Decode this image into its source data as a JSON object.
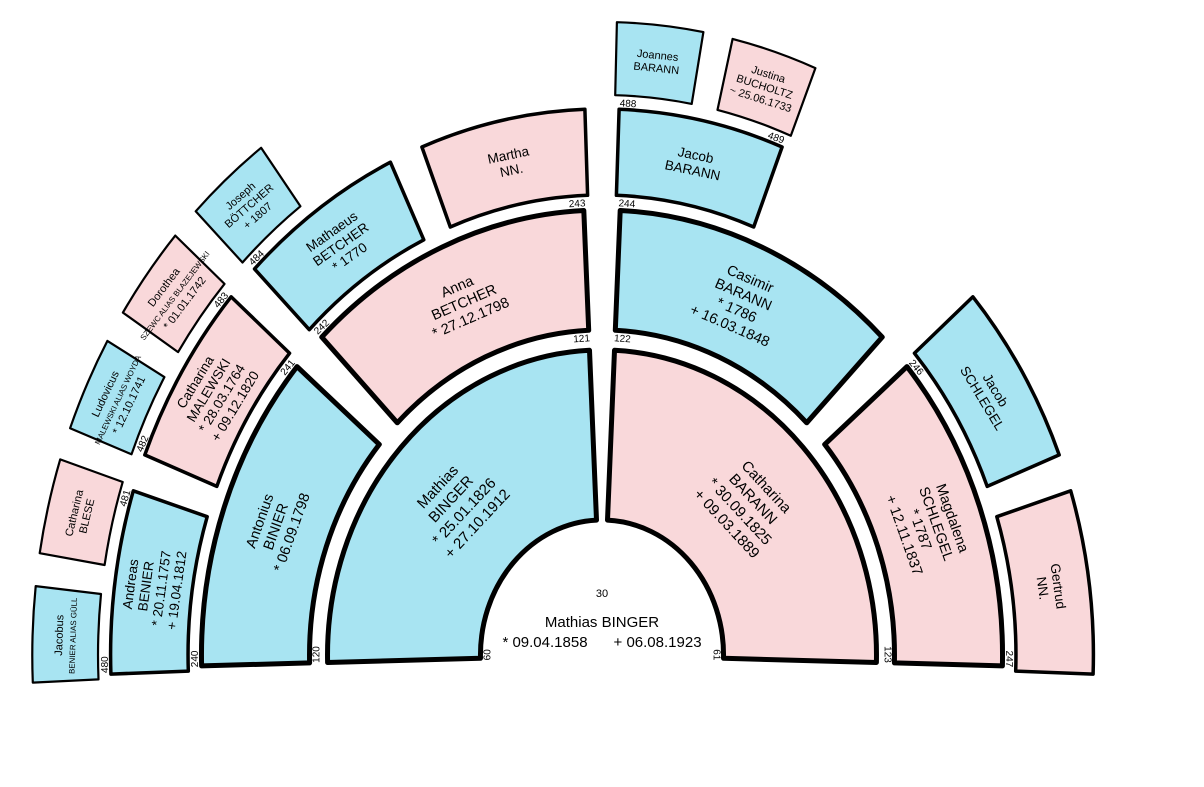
{
  "chart_data": {
    "type": "genealogy-fan",
    "center": {
      "number": "30",
      "name": "Mathias BINGER",
      "birth": "* 09.04.1858",
      "death": "+ 06.08.1923"
    },
    "colors": {
      "male": "#a8e4f2",
      "female": "#f9d8da",
      "outline": "#000000",
      "background": "#ffffff"
    },
    "persons": [
      {
        "number": "60",
        "sex": "male",
        "ring": 1,
        "slot": 0,
        "label_side": "start",
        "lines": [
          "Mathias",
          "BINGER",
          "* 25.01.1826",
          "+ 27.10.1912"
        ]
      },
      {
        "number": "61",
        "sex": "female",
        "ring": 1,
        "slot": 1,
        "label_side": "end",
        "lines": [
          "Catharina",
          "BARANN",
          "* 30.09.1825",
          "+ 09.03.1889"
        ]
      },
      {
        "number": "120",
        "sex": "male",
        "ring": 2,
        "slot": 0,
        "label_side": "start",
        "lines": [
          "Antonius",
          "BINIER",
          "* 06.09.1798"
        ]
      },
      {
        "number": "121",
        "sex": "female",
        "ring": 2,
        "slot": 1,
        "label_side": "end",
        "lines": [
          "Anna",
          "BETCHER",
          "* 27.12.1798"
        ]
      },
      {
        "number": "122",
        "sex": "male",
        "ring": 2,
        "slot": 2,
        "label_side": "start",
        "lines": [
          "Casimir",
          "BARANN",
          "* 1786",
          "+ 16.03.1848"
        ]
      },
      {
        "number": "123",
        "sex": "female",
        "ring": 2,
        "slot": 3,
        "label_side": "end",
        "lines": [
          "Magdalena",
          "SCHLEGEL",
          "* 1787",
          "+ 12.11.1837"
        ]
      },
      {
        "number": "240",
        "sex": "male",
        "ring": 3,
        "slot": 0,
        "label_side": "start",
        "lines": [
          "Andreas",
          "BENIER",
          "* 20.11.1757",
          "+ 19.04.1812"
        ]
      },
      {
        "number": "241",
        "sex": "female",
        "ring": 3,
        "slot": 1,
        "label_side": "end",
        "lines": [
          "Catharina",
          "MALEWSKI",
          "* 28.03.1764",
          "+ 09.12.1820"
        ]
      },
      {
        "number": "242",
        "sex": "male",
        "ring": 3,
        "slot": 2,
        "label_side": "start",
        "lines": [
          "Mathaeus",
          "BETCHER",
          "* 1770"
        ]
      },
      {
        "number": "243",
        "sex": "female",
        "ring": 3,
        "slot": 3,
        "label_side": "end",
        "lines": [
          "Martha",
          "NN."
        ]
      },
      {
        "number": "244",
        "sex": "male",
        "ring": 3,
        "slot": 4,
        "label_side": "start",
        "lines": [
          "Jacob",
          "BARANN"
        ]
      },
      {
        "number": "246",
        "sex": "male",
        "ring": 3,
        "slot": 6,
        "label_side": "start",
        "lines": [
          "Jacob",
          "SCHLEGEL"
        ]
      },
      {
        "number": "247",
        "sex": "female",
        "ring": 3,
        "slot": 7,
        "label_side": "end",
        "lines": [
          "Gertrud",
          "NN."
        ]
      },
      {
        "number": "480",
        "sex": "male",
        "ring": 4,
        "slot": 0,
        "label_side": "start",
        "lines": [
          "Jacobus",
          "BENIER ALIAS GÜLL"
        ]
      },
      {
        "number": "481",
        "sex": "female",
        "ring": 4,
        "slot": 1,
        "label_side": "end",
        "lines": [
          "Catharina",
          "BLESE"
        ]
      },
      {
        "number": "482",
        "sex": "male",
        "ring": 4,
        "slot": 2,
        "label_side": "start",
        "lines": [
          "Ludovicus",
          "MALEWSKI ALIAS WOYDA",
          "* 12.10.1741"
        ]
      },
      {
        "number": "483",
        "sex": "female",
        "ring": 4,
        "slot": 3,
        "label_side": "end",
        "lines": [
          "Dorothea",
          "SZEWC ALIAS BLAZEJEWSKI",
          "* 01.01.1742"
        ]
      },
      {
        "number": "484",
        "sex": "male",
        "ring": 4,
        "slot": 4,
        "label_side": "start",
        "lines": [
          "Joseph",
          "BÖTTCHER",
          "+ 1807"
        ]
      },
      {
        "number": "488",
        "sex": "male",
        "ring": 4,
        "slot": 8,
        "label_side": "start",
        "lines": [
          "Joannes",
          "BARANN"
        ]
      },
      {
        "number": "489",
        "sex": "female",
        "ring": 4,
        "slot": 9,
        "label_side": "end",
        "lines": [
          "Justina",
          "BUCHOLTZ",
          "~ 25.06.1733"
        ]
      }
    ]
  }
}
